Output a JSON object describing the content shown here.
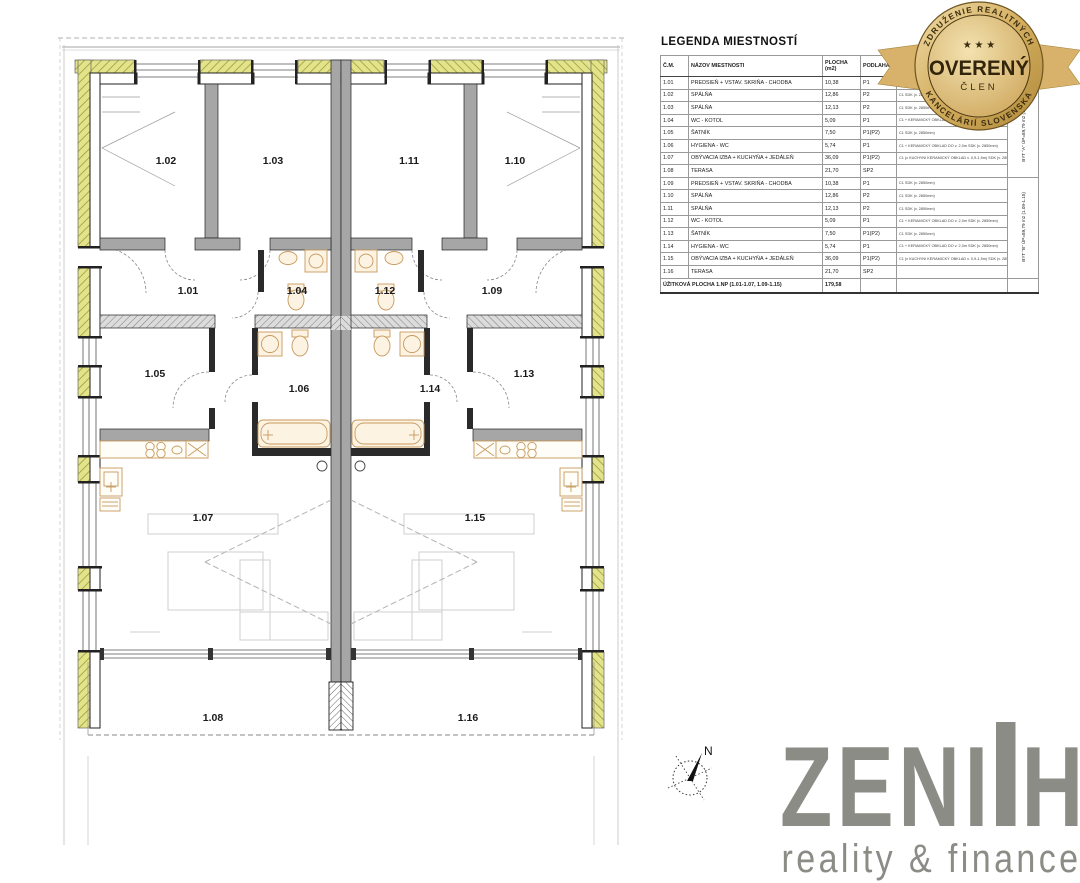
{
  "legend": {
    "title": "LEGENDA MIESTNOSTÍ",
    "columns": [
      "Č.M.",
      "NÁZOV MIESTNOSTI",
      "PLOCHA\n(m2)",
      "PODLAHA",
      "",
      ""
    ],
    "rows": [
      {
        "num": "1.01",
        "name": "PREDSIEŇ + VSTAV. SKRIŇA - CHODBA",
        "area": "10,38",
        "floor": "P1",
        "finish": "C1\nSDK (v. 2850mm)"
      },
      {
        "num": "1.02",
        "name": "SPÁLŇA",
        "area": "12,86",
        "floor": "P2",
        "finish": "C1\nSDK (v. 2850mm)"
      },
      {
        "num": "1.03",
        "name": "SPÁLŇA",
        "area": "12,13",
        "floor": "P2",
        "finish": "C1\nSDK (v. 2850mm)"
      },
      {
        "num": "1.04",
        "name": "WC - KOTOL",
        "area": "5,09",
        "floor": "P1",
        "finish": "C1 + KERAMICKÝ OBKLAD DO v. 2,0m\nSDK (v. 2850mm)"
      },
      {
        "num": "1.05",
        "name": "ŠATNÍK",
        "area": "7,50",
        "floor": "P1(P2)",
        "finish": "C1\nSDK (v. 2850mm)"
      },
      {
        "num": "1.06",
        "name": "HYGIENA - WC",
        "area": "5,74",
        "floor": "P1",
        "finish": "C1 + KERAMICKÝ OBKLAD DO v. 2,0m\nSDK (v. 2850mm)"
      },
      {
        "num": "1.07",
        "name": "OBÝVACIA IZBA + KUCHYŇA + JEDÁLEŇ",
        "area": "36,09",
        "floor": "P1(P2)",
        "finish": "C1 (v KUCHYNI KERAMICKÝ OBKLAD v. 0,9-1,5m)\nSDK (v. 2850mm)"
      },
      {
        "num": "1.08",
        "name": "TERASA",
        "area": "21,70",
        "floor": "SP2",
        "finish": ""
      },
      {
        "num": "1.09",
        "name": "PREDSIEŇ + VSTAV. SKRIŇA - CHODBA",
        "area": "10,38",
        "floor": "P1",
        "finish": "C1\nSDK (v. 2850mm)"
      },
      {
        "num": "1.10",
        "name": "SPÁLŇA",
        "area": "12,86",
        "floor": "P2",
        "finish": "C1\nSDK (v. 2850mm)"
      },
      {
        "num": "1.11",
        "name": "SPÁLŇA",
        "area": "12,13",
        "floor": "P2",
        "finish": "C1\nSDK (v. 2850mm)"
      },
      {
        "num": "1.12",
        "name": "WC - KOTOL",
        "area": "5,09",
        "floor": "P1",
        "finish": "C1 + KERAMICKÝ OBKLAD DO v. 2,0m\nSDK (v. 2850mm)"
      },
      {
        "num": "1.13",
        "name": "ŠATNÍK",
        "area": "7,50",
        "floor": "P1(P2)",
        "finish": "C1\nSDK (v. 2850mm)"
      },
      {
        "num": "1.14",
        "name": "HYGIENA - WC",
        "area": "5,74",
        "floor": "P1",
        "finish": "C1 + KERAMICKÝ OBKLAD DO v. 2,0m\nSDK (v. 2850mm)"
      },
      {
        "num": "1.15",
        "name": "OBÝVACIA IZBA + KUCHYŇA + JEDÁLEŇ",
        "area": "36,09",
        "floor": "P1(P2)",
        "finish": "C1 (v KUCHYNI KERAMICKÝ OBKLAD v. 0,9-1,5m)\nSDK (v. 2850mm)"
      },
      {
        "num": "1.16",
        "name": "TERASA",
        "area": "21,70",
        "floor": "SP2",
        "finish": ""
      }
    ],
    "flat_a": "BYT \"A\"\nÚP=89,79 m2 (1.01-1.07)",
    "flat_b": "BYT \"B\"\nÚP=89,79 m2 (1.09-1.15)",
    "total_label": "ÚŽITKOVÁ PLOCHA 1.NP (1.01-1.07, 1.09-1.15)",
    "total_value": "179,58"
  },
  "badge": {
    "arc_top": "ZDRUŽENIE REALITNÝCH",
    "arc_bottom": "KANCELÁRIÍ SLOVENSKA",
    "stars": "★ ★ ★",
    "main": "OVERENÝ",
    "sub": "ČLEN"
  },
  "logo": {
    "word_part1": "ZENI",
    "word_part2": "H",
    "word_full": "ZENITH",
    "tagline": "reality & finance"
  },
  "compass": {
    "label": "N"
  },
  "plan": {
    "rooms": [
      {
        "id": "1.01",
        "x": 188,
        "y": 294
      },
      {
        "id": "1.02",
        "x": 166,
        "y": 164
      },
      {
        "id": "1.03",
        "x": 273,
        "y": 164
      },
      {
        "id": "1.04",
        "x": 297,
        "y": 294
      },
      {
        "id": "1.05",
        "x": 155,
        "y": 377
      },
      {
        "id": "1.06",
        "x": 299,
        "y": 392
      },
      {
        "id": "1.07",
        "x": 203,
        "y": 521
      },
      {
        "id": "1.08",
        "x": 213,
        "y": 721
      },
      {
        "id": "1.09",
        "x": 492,
        "y": 294
      },
      {
        "id": "1.10",
        "x": 515,
        "y": 164
      },
      {
        "id": "1.11",
        "x": 409,
        "y": 164
      },
      {
        "id": "1.12",
        "x": 385,
        "y": 294
      },
      {
        "id": "1.13",
        "x": 524,
        "y": 377
      },
      {
        "id": "1.14",
        "x": 430,
        "y": 392
      },
      {
        "id": "1.15",
        "x": 475,
        "y": 521
      },
      {
        "id": "1.16",
        "x": 468,
        "y": 721
      }
    ]
  },
  "colors": {
    "insulation": "#e3e38b",
    "insulation_hatch": "#9d9d3a",
    "wall_gray": "#a6a6a6",
    "fixture": "#c79a5e",
    "logo_gray": "#8c8c86",
    "badge_gold": "#d3ad5e",
    "badge_text": "#3c2d10"
  }
}
